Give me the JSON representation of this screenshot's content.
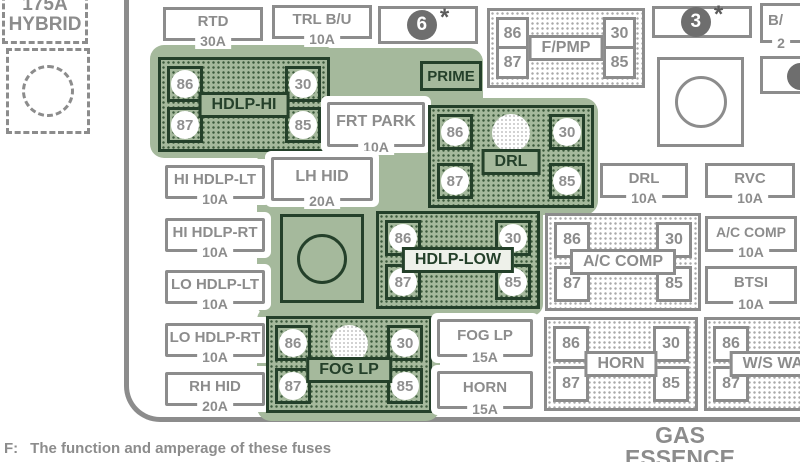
{
  "colors": {
    "highlight_green": "#a5b99c",
    "dark_green": "#24402a",
    "gray": "#8c8c8c"
  },
  "mega_fuse": {
    "line1": "175A",
    "line2": "HYBRID"
  },
  "prime_label": "PRIME",
  "markers": {
    "m6": {
      "num": "6",
      "star": "*"
    },
    "m3": {
      "num": "3",
      "star": "*"
    }
  },
  "fuses": {
    "rtd": {
      "name": "RTD",
      "amp": "30A"
    },
    "trl_bu": {
      "name": "TRL B/U",
      "amp": "10A"
    },
    "frt_park": {
      "name": "FRT PARK",
      "amp": "10A"
    },
    "lh_hid": {
      "name": "LH HID",
      "amp": "20A"
    },
    "hi_hdlp_lt": {
      "name": "HI HDLP-LT",
      "amp": "10A"
    },
    "hi_hdlp_rt": {
      "name": "HI HDLP-RT",
      "amp": "10A"
    },
    "lo_hdlp_lt": {
      "name": "LO HDLP-LT",
      "amp": "10A"
    },
    "lo_hdlp_rt": {
      "name": "LO HDLP-RT",
      "amp": "10A"
    },
    "rh_hid": {
      "name": "RH HID",
      "amp": "20A"
    },
    "drl": {
      "name": "DRL",
      "amp": "10A"
    },
    "rvc": {
      "name": "RVC",
      "amp": "10A"
    },
    "ac_comp": {
      "name": "A/C COMP",
      "amp": "10A"
    },
    "btsi": {
      "name": "BTSI",
      "amp": "10A"
    },
    "fog_lp": {
      "name": "FOG LP",
      "amp": "15A"
    },
    "horn": {
      "name": "HORN",
      "amp": "15A"
    },
    "bu_cut": {
      "name": "B/",
      "amp": "2"
    }
  },
  "relays": {
    "hdlp_hi": {
      "label": "HDLP-HI",
      "pins": {
        "tl": "86",
        "tr": "30",
        "bl": "87",
        "br": "85"
      }
    },
    "drl": {
      "label": "DRL",
      "pins": {
        "tl": "86",
        "tr": "30",
        "bl": "87",
        "br": "85"
      }
    },
    "hdlp_low": {
      "label": "HDLP-LOW",
      "pins": {
        "tl": "86",
        "tr": "30",
        "bl": "87",
        "br": "85"
      }
    },
    "fog_lp": {
      "label": "FOG LP",
      "pins": {
        "tl": "86",
        "tr": "30",
        "bl": "87",
        "br": "85"
      }
    },
    "f_pmp": {
      "label": "F/PMP",
      "pins": {
        "tl": "86",
        "tr": "30",
        "bl": "87",
        "br": "85"
      }
    },
    "ac_comp": {
      "label": "A/C COMP",
      "pins": {
        "tl": "86",
        "tr": "30",
        "bl": "87",
        "br": "85"
      }
    },
    "horn": {
      "label": "HORN",
      "pins": {
        "tl": "86",
        "tr": "30",
        "bl": "87",
        "br": "85"
      }
    },
    "ws_wash": {
      "label": "W/S WASH",
      "pins": {
        "tl": "86",
        "bl": "87"
      }
    }
  },
  "bottom": {
    "line1": "GAS",
    "line2": "ESSENCE"
  },
  "footnote": {
    "prefix": "F:",
    "text": "The function and amperage of these fuses"
  }
}
